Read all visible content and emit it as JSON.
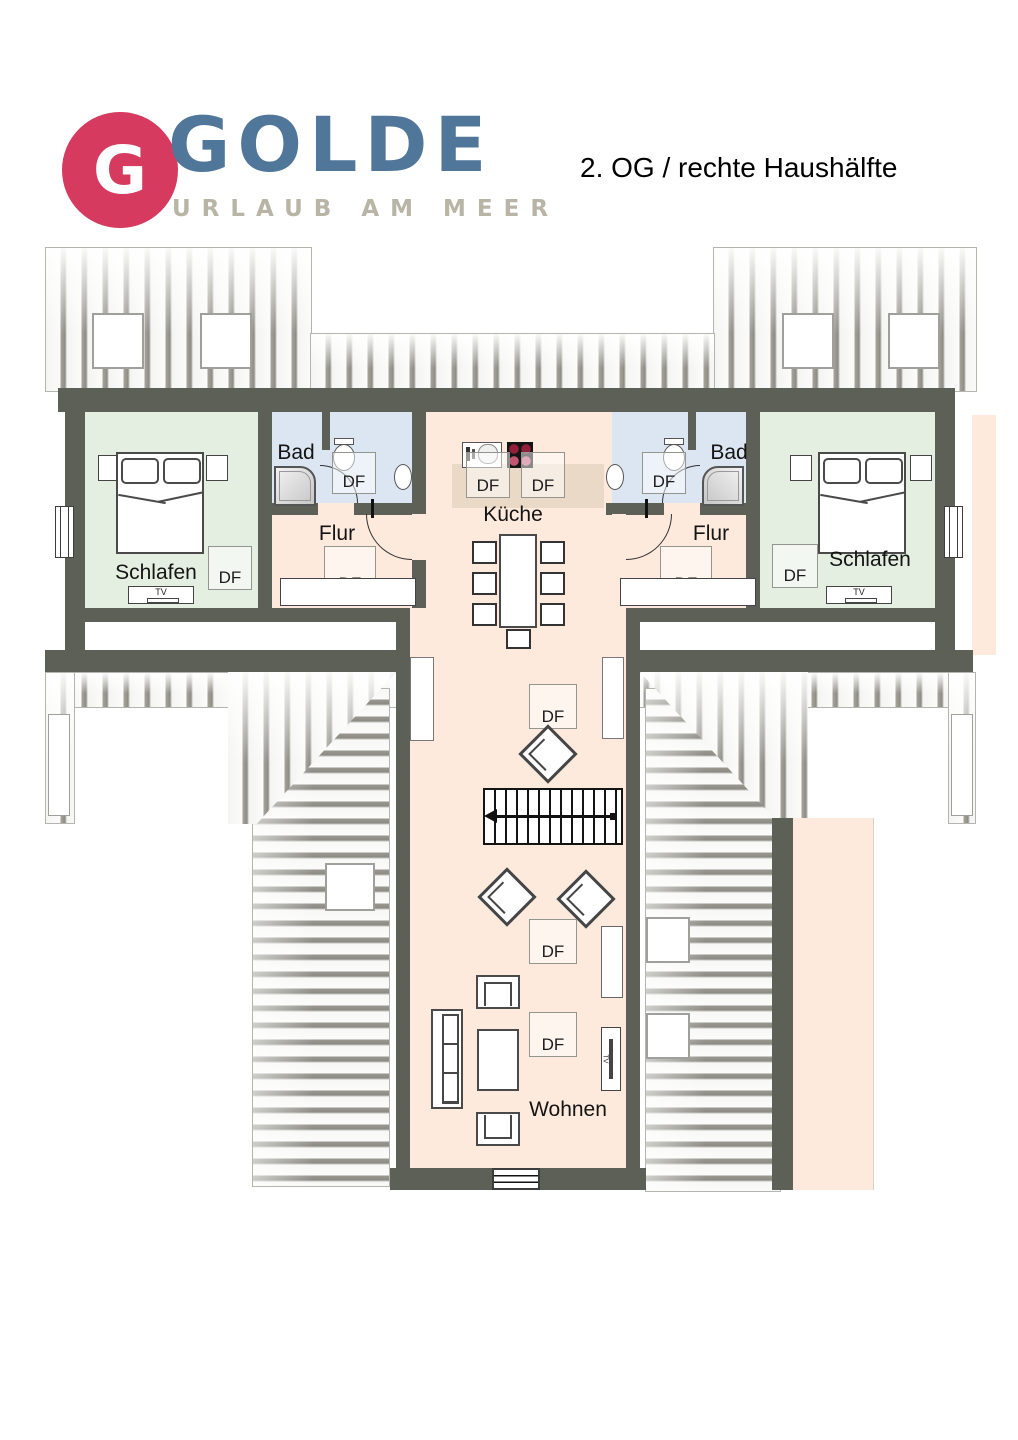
{
  "header": {
    "logo_letter": "G",
    "brand": "GOLDE",
    "tagline": "URLAUB AM MEER",
    "plan_title": "2. OG / rechte Haushälfte"
  },
  "rooms": {
    "bedroom_left": "Schlafen",
    "bedroom_right": "Schlafen",
    "bath_left": "Bad",
    "bath_right": "Bad",
    "hall_left": "Flur",
    "hall_right": "Flur",
    "kitchen": "Küche",
    "living_room": "Wohnen"
  },
  "labels": {
    "df": "DF",
    "tv": "TV"
  },
  "colors": {
    "wall": "#5d6056",
    "floor_peach": "#fdeadd",
    "bedroom_green": "#e4efe2",
    "bath_blue": "#dce6f3",
    "kitchen_counter": "#ebd9c7",
    "brand_red": "#d63a5f",
    "brand_blue": "#50769a",
    "tagline_gray": "#b8b5a6",
    "stove_burner_dark": "#93203a",
    "stove_burner_light": "#c25672"
  }
}
